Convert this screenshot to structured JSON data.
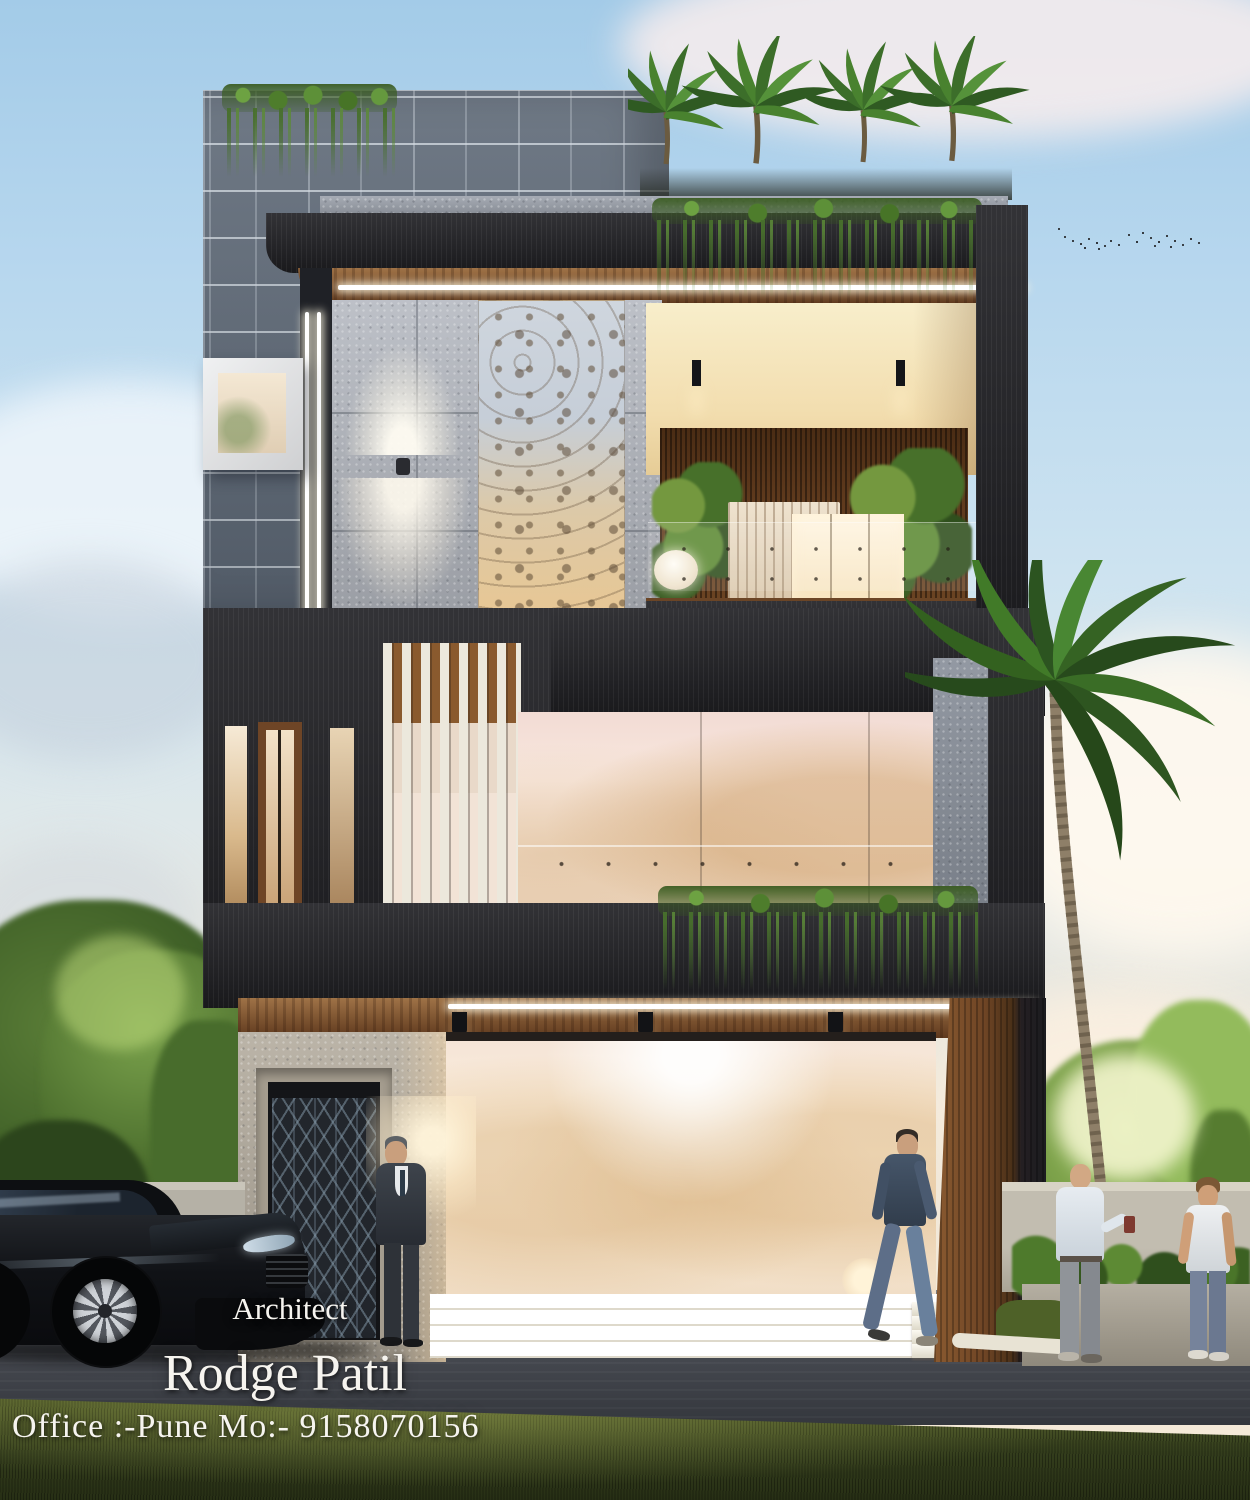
{
  "overlay": {
    "architect_label": "Architect",
    "name": "Rodge Patil",
    "office_line": "Office :-Pune Mo:- 9158070156"
  },
  "palette": {
    "sky_top": "#a3cbe8",
    "sky_warm": "#f6ead8",
    "brick": "#5f6a78",
    "mortar": "#9aa4b0",
    "concrete": "#b4b8c0",
    "charcoal_wood": "#232327",
    "brown_wood": "#7a4c28",
    "warm_glow": "#f7e2b8",
    "glass_reflection": "#f8e8de",
    "foliage": "#4d7a33",
    "grass": "#3e4a22",
    "road": "#43464d",
    "text": "#f6f4ef"
  }
}
